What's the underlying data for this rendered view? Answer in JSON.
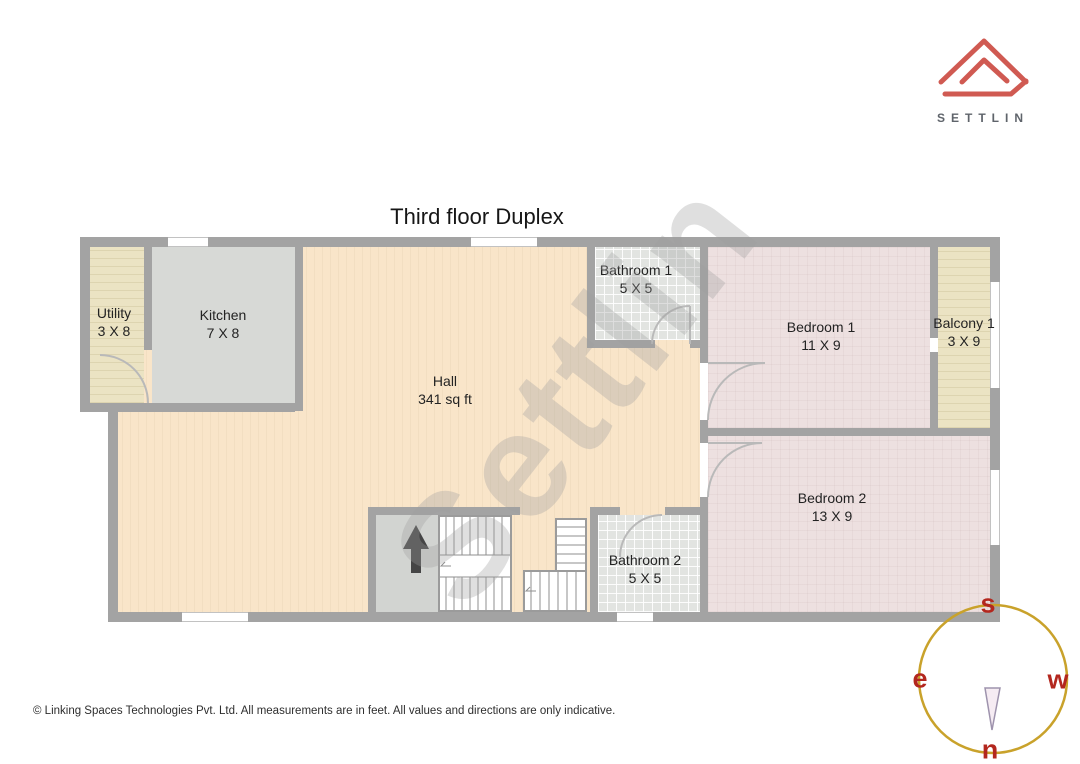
{
  "title": "Third floor Duplex",
  "watermark": "Settlin",
  "logo": {
    "brand": "SETTLIN",
    "house_color": "#d05a52",
    "wordmark_color": "#5f646b"
  },
  "disclaimer": "© Linking Spaces Technologies Pvt. Ltd. All measurements are in feet. All values and directions are only indicative.",
  "compass": {
    "top": "s",
    "left": "e",
    "right": "w",
    "bottom": "n",
    "circle_color": "#c9a22b",
    "letter_color": "#b3271e"
  },
  "rooms": [
    {
      "name": "Utility",
      "dims": "3 X 8"
    },
    {
      "name": "Kitchen",
      "dims": "7 X 8"
    },
    {
      "name": "Hall",
      "dims": "341 sq ft"
    },
    {
      "name": "Bathroom 1",
      "dims": "5 X 5"
    },
    {
      "name": "Bedroom 1",
      "dims": "11 X 9"
    },
    {
      "name": "Balcony 1",
      "dims": "3 X 9"
    },
    {
      "name": "Bedroom 2",
      "dims": "13 X 9"
    },
    {
      "name": "Bathroom 2",
      "dims": "5 X 5"
    }
  ],
  "colors": {
    "hall_floor": "#f9e5c9",
    "bedroom_floor": "#ede0e0",
    "bathroom_floor": "#e2e4e1",
    "kitchen_floor": "#d7d9d6",
    "deck_floor": "#ebe3c3",
    "wall": "#a3a3a3"
  }
}
